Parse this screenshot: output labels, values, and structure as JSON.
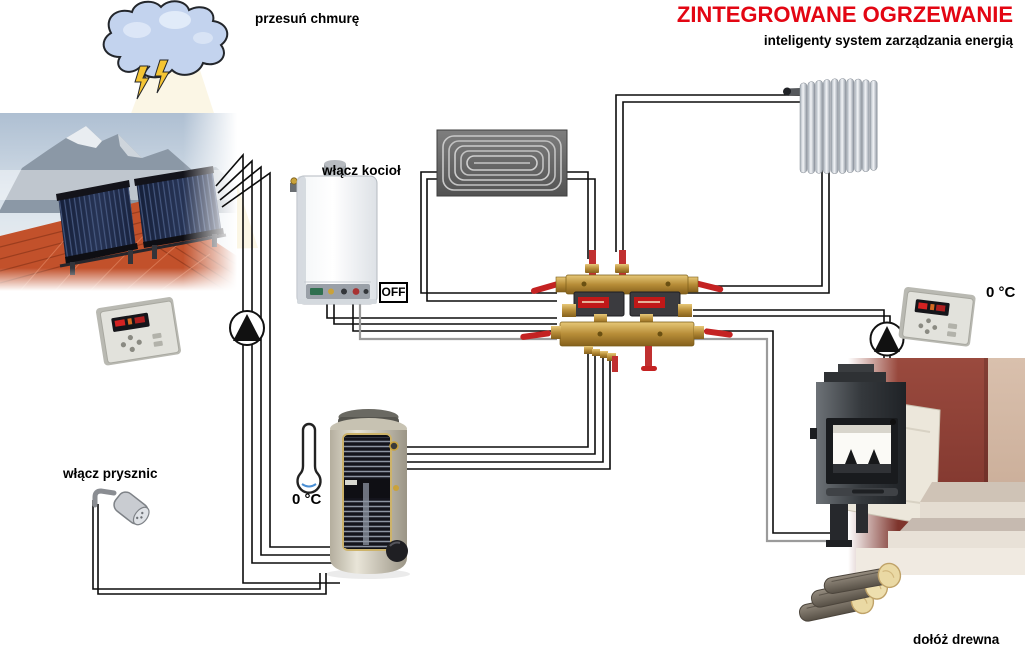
{
  "header": {
    "title": "ZINTEGROWANE OGRZEWANIE",
    "subtitle": "inteligenty system zarządzania energią",
    "title_color": "#e30613"
  },
  "annotations": {
    "cloud_label": "przesuń chmurę",
    "boiler_label": "włącz kocioł",
    "boiler_switch_label": "OFF",
    "shower_label": "włącz prysznic",
    "tank_temp": "0 °C",
    "fireplace_temp": "0 °C",
    "wood_label": "dołóż drewna"
  },
  "colors": {
    "title_red": "#e30613",
    "pipe_black": "#0c0c0c",
    "pipe_gray": "#9b9b9b",
    "valve_red": "#c42222",
    "brass": "#b98f3e",
    "cloud_fill": "#c3d3ee",
    "wall_red": "#8d4036"
  },
  "components": {
    "cloud": "draggable sun-blocking cloud",
    "solar_collector": "rooftop solar collectors photo",
    "boiler": "wall-hung gas boiler",
    "floor_heating": "underfloor heating coil",
    "radiator": "room radiator",
    "manifold": "brass valve and pump manifold",
    "buffer_tank": "hot water storage tank",
    "shower": "shower head",
    "fireplace": "wood fireplace insert",
    "wood_logs": "firewood logs",
    "controller_left": "temperature controller",
    "controller_right": "temperature controller",
    "pump_left": "circulation pump",
    "pump_right": "circulation pump"
  }
}
